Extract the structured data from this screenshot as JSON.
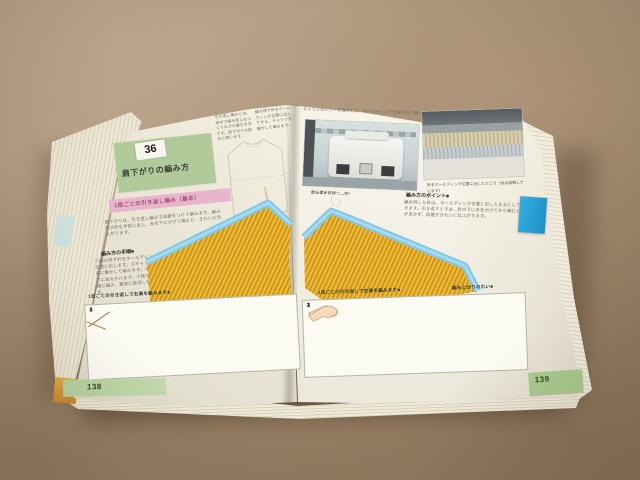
{
  "scene": {
    "description": "Open Japanese machine-knitting instruction book lying on brown cardboard",
    "colors": {
      "cardboard": "#ab9276",
      "page": "#f3efe1",
      "title_box_green": "#b0ca9a",
      "heading_pink": "#e7b6cc",
      "swatch_yellow": "#e2a71e",
      "swatch_edge_blue": "#85c9e6",
      "page_tab_green": "#b6d29e",
      "index_tab_blue": "#2ba7dc",
      "corner_tab_orange": "#d99a33"
    }
  },
  "left_page": {
    "page_number": "138",
    "section_number": "36",
    "section_title": "肩下がりの編み方",
    "pink_heading": "1段ごとの引き返し編み（基本）",
    "top_text_a": "引き返し編みとは、途中で編み残しをつくりながら編む方法です。肩下がりの部分に使います。",
    "top_text_b": "編み残す針をホールディング位置に出してから、キャリジを動かして編みます。",
    "intro_text": "肩下がりは、引き返し編みで段差をつけて編みます。編み残す針を手前に出し、糸を下にかけて編むと、きれいに仕上がります。",
    "sub_heading": "編み方の手順■",
    "column_text": "①編み残す針をホールディング位置に出します。②キャリジを右に動かして編みます。③針の下に糸をかけます。④残りも同様に編み、最後に段消しをします。",
    "diagram_caption": "1目ごとの引き返しで右肩を編みます■",
    "diagram_numbers": [
      "1",
      "2",
      "3"
    ]
  },
  "right_page": {
    "page_number": "139",
    "top_caption": "キャリジのレバーを操作して、ホールディング位置の針で編みます。",
    "photo_a_labels": [
      "ホールドレバー……I",
      "カムダイヤル……中",
      "ロシアレバー……○"
    ],
    "photo_b_caption": "針をホールディング位置に出したところ（糸は省略しています）",
    "body_heading": "編み方のポイント■",
    "body_text": "編み残した針は、ホールディング位置に出したままにしておきます。引き返すときは、針の下に糸をかけてから編むと穴があかず、段差がきれいに仕上がります。",
    "swatch_caption": "編み上がりのれい■",
    "diagram_caption": "1目ごとの引き返しで左肩を編みます■",
    "diagram_numbers": [
      "1",
      "2",
      "3"
    ]
  }
}
